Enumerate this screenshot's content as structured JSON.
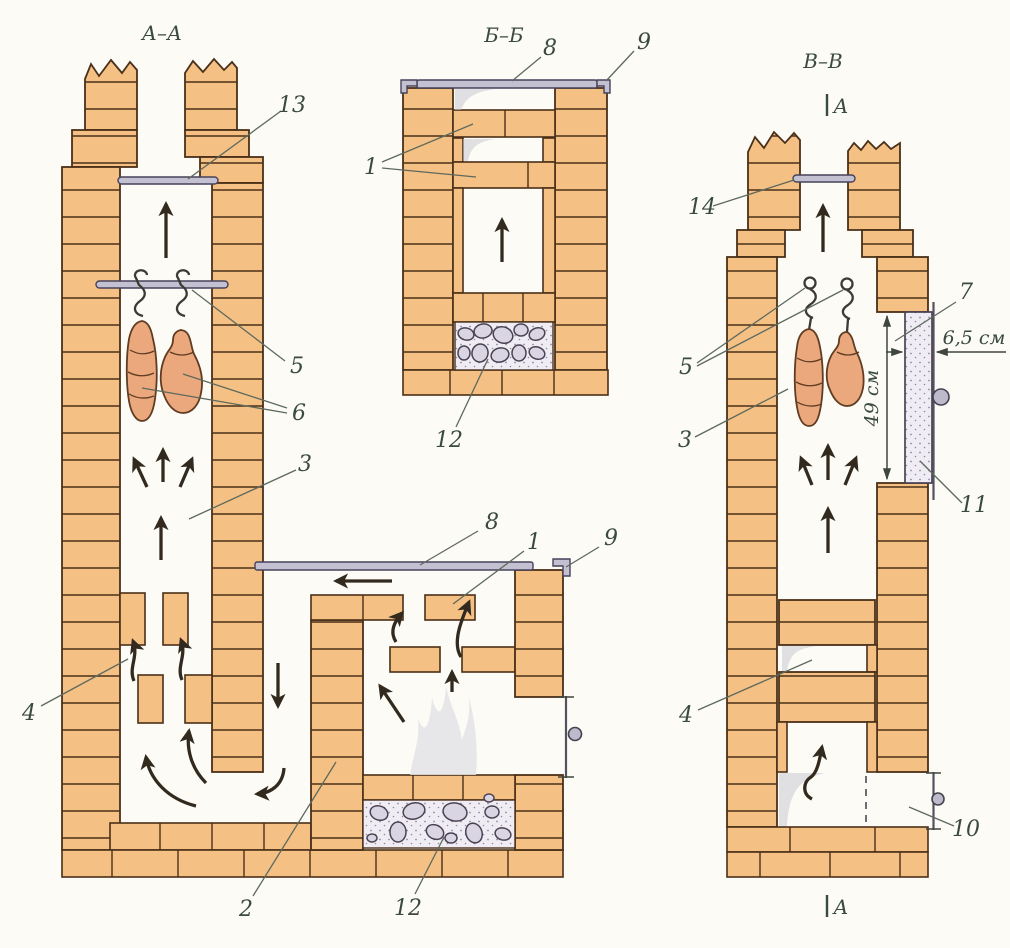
{
  "diagram": {
    "type": "construction-cross-sections",
    "subject": "brick smokehouse / smoking oven masonry sections",
    "colors": {
      "brick": "#f5c083",
      "outline": "#4a3018",
      "metal": "#c3c0d2",
      "meat": "#eba87d",
      "stone": "#d9d5e3",
      "label": "#3a4a40",
      "background": "#fcfbf6"
    },
    "sections": {
      "aa": {
        "title": "А–А",
        "callouts": {
          "n1": "1",
          "n2": "2",
          "n3": "3",
          "n4": "4",
          "n5": "5",
          "n6": "6",
          "n8": "8",
          "n9": "9",
          "n12": "12",
          "n13": "13"
        }
      },
      "bb": {
        "title": "Б–Б",
        "callouts": {
          "n1": "1",
          "n8": "8",
          "n9": "9",
          "n12": "12"
        }
      },
      "vv": {
        "title": "В–В",
        "cut_marker": "А",
        "callouts": {
          "n3": "3",
          "n4": "4",
          "n5": "5",
          "n7": "7",
          "n10": "10",
          "n11": "11",
          "n14": "14"
        },
        "dimensions": {
          "door_width": "6,5 см",
          "door_height": "49 см"
        }
      }
    }
  }
}
